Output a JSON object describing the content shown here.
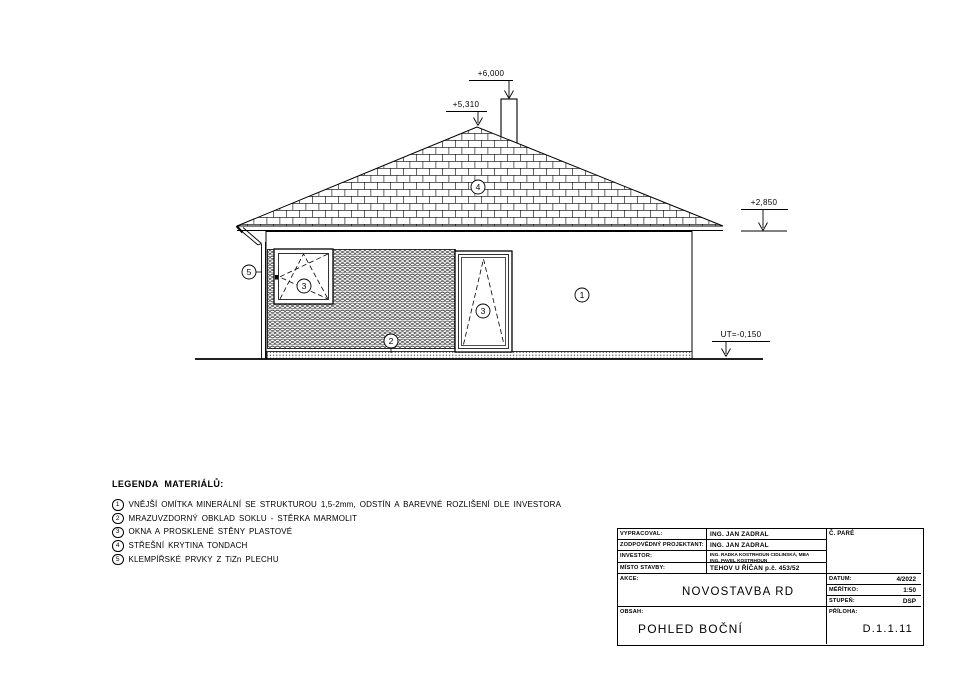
{
  "page": {
    "background": "#ffffff",
    "ink": "#000000"
  },
  "drawing": {
    "levels": {
      "chimney_top": "+6,000",
      "ridge": "+5,310",
      "eave": "+2,850",
      "terrain": "UT=-0,150"
    },
    "markers": {
      "plaster": "1",
      "socle": "2",
      "window": "3",
      "roof": "4",
      "flashing": "5"
    }
  },
  "legend": {
    "title": "LEGENDA MATERIÁLŮ:",
    "items": [
      {
        "num": "1",
        "text": "VNĚJŠÍ OMÍTKA MINERÁLNÍ SE STRUKTUROU 1,5-2mm, ODSTÍN A BAREVNÉ ROZLIŠENÍ DLE INVESTORA"
      },
      {
        "num": "2",
        "text": "MRAZUVZDORNÝ OBKLAD SOKLU - STĚRKA MARMOLIT"
      },
      {
        "num": "3",
        "text": "OKNA A PROSKLENÉ STĚNY PLASTOVÉ"
      },
      {
        "num": "4",
        "text": "STŘEŠNÍ KRYTINA TONDACH"
      },
      {
        "num": "5",
        "text": "KLEMPÍŘSKÉ PRVKY Z TiZn PLECHU"
      }
    ]
  },
  "titleblock": {
    "vypracoval_label": "VYPRACOVAL:",
    "vypracoval_value": "ING. JAN ZADRAL",
    "zodpovedny_label": "ZODPOVĚDNÝ PROJEKTANT:",
    "zodpovedny_value": "ING. JAN ZADRAL",
    "investor_label": "INVESTOR:",
    "investor_line1": "ING. RADKA KOSTRHOUN CIDLINSKÁ, MBA",
    "investor_line2": "ING. PAVEL KOSTRHOUN",
    "misto_label": "MÍSTO STAVBY:",
    "misto_value": "TEHOV U ŘÍČAN p.č. 453/52",
    "pare_label": "Č. PARÉ",
    "akce_label": "AKCE:",
    "akce_value": "NOVOSTAVBA RD",
    "obsah_label": "OBSAH:",
    "obsah_value": "POHLED BOČNÍ",
    "datum_label": "DATUM:",
    "datum_value": "4/2022",
    "meritko_label": "MĚŘÍTKO:",
    "meritko_value": "1:50",
    "stupen_label": "STUPEŇ:",
    "stupen_value": "DSP",
    "priloha_label": "PŘÍLOHA:",
    "priloha_value": "D.1.1.11"
  }
}
